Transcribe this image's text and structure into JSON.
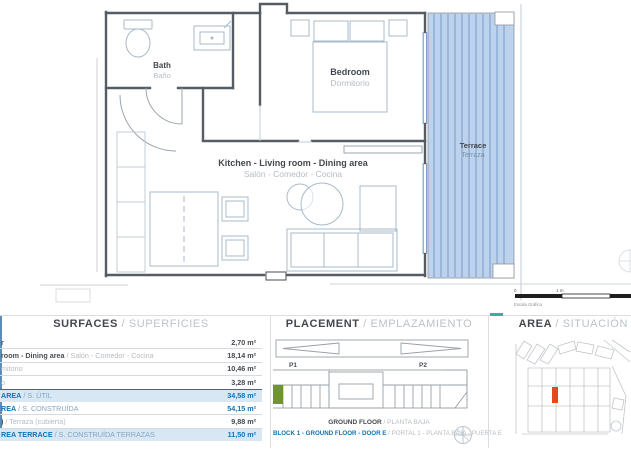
{
  "plan": {
    "bath_en": "Bath",
    "bath_es": "Baño",
    "bedroom_en": "Bedroom",
    "bedroom_es": "Dormitorio",
    "living_en": "Kitchen - Living room - Dining area",
    "living_es": "Salón - Comedor - Cocina",
    "terrace_en": "Terrace",
    "terrace_es": "Terraza",
    "scale_zero": "0",
    "scale_one": "1 m",
    "scale_caption": "Escala Gráfica"
  },
  "surfaces": {
    "title": "SURFACES",
    "subtitle": "/ SUPERFICIES",
    "rows": [
      {
        "en": "r",
        "es": "",
        "value": "2,70 m²"
      },
      {
        "en": "room - Dining area",
        "es": " / Salón - Comedor - Cocina",
        "value": "18,14 m²"
      },
      {
        "en": "",
        "es": "mitorio",
        "value": "10,46 m²"
      },
      {
        "en": "",
        "es": "o",
        "value": "3,28 m²"
      },
      {
        "en": "AREA",
        "es": " / S. ÚTIL",
        "value": "34,58 m²"
      },
      {
        "en": "REA",
        "es": " / S. CONSTRUÍDA",
        "value": "54,15 m²"
      },
      {
        "en": ")",
        "es": " / Terraza (cubierta)",
        "value": "9,88 m²"
      },
      {
        "en": "REA TERRACE",
        "es": " / S. CONSTRUÍDA TERRAZAS",
        "value": "11,50 m²"
      }
    ]
  },
  "placement": {
    "title": "PLACEMENT",
    "subtitle": "/ EMPLAZAMIENTO",
    "p1": "P1",
    "p2": "P2",
    "floor_en": "GROUND FLOOR",
    "floor_es": " / PLANTA BAJA",
    "unit_en": "BLOCK 1 - GROUND FLOOR - DOOR E",
    "unit_es": " / PORTAL 1 - PLANTA BAJA - PUERTA E"
  },
  "area_panel": {
    "title": "AREA",
    "subtitle": "/ SITUACIÓN"
  },
  "colors": {
    "accent_blue": "#0e74b8",
    "row_highlight": "#d7e7f4",
    "terrace_fill": "#bdd2ec",
    "terrace_stripe": "#7094c4",
    "unit_green": "#6f9431",
    "plot_red": "#e2491b"
  }
}
